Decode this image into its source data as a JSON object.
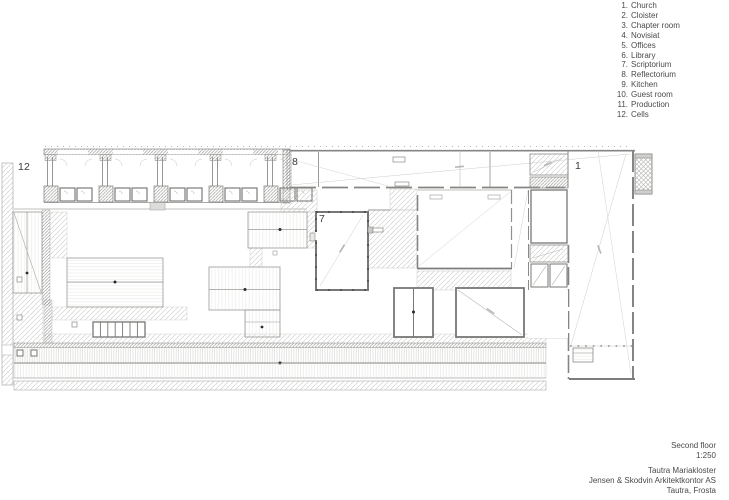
{
  "legend": {
    "items": [
      {
        "num": "1.",
        "label": "Church"
      },
      {
        "num": "2.",
        "label": "Cloister"
      },
      {
        "num": "3.",
        "label": "Chapter room"
      },
      {
        "num": "4.",
        "label": "Novisiat"
      },
      {
        "num": "5.",
        "label": "Offices"
      },
      {
        "num": "6.",
        "label": "Library"
      },
      {
        "num": "7.",
        "label": "Scriptorium"
      },
      {
        "num": "8.",
        "label": "Reflectorium"
      },
      {
        "num": "9.",
        "label": "Kitchen"
      },
      {
        "num": "10.",
        "label": "Guest room"
      },
      {
        "num": "11.",
        "label": "Production"
      },
      {
        "num": "12.",
        "label": "Cells"
      }
    ]
  },
  "title_block": {
    "floor": "Second floor",
    "scale": "1:250",
    "project": "Tautra Mariakloster",
    "architect": "Jensen & Skodvin Arkitektkontor AS",
    "location": "Tautra, Frosta"
  },
  "plan_labels": {
    "cells": "12",
    "reflectorium": "8",
    "scriptorium": "7",
    "church": "1"
  },
  "colors": {
    "background": "#ffffff",
    "wall_heavy": "#7d7d7b",
    "wall_medium": "#929290",
    "hatch": "#c7c7c5",
    "hatch_dense": "#a3a3a1",
    "fill_light": "#f3f3f1",
    "text": "#4a4a4a",
    "dot": "#2a2a2a"
  }
}
